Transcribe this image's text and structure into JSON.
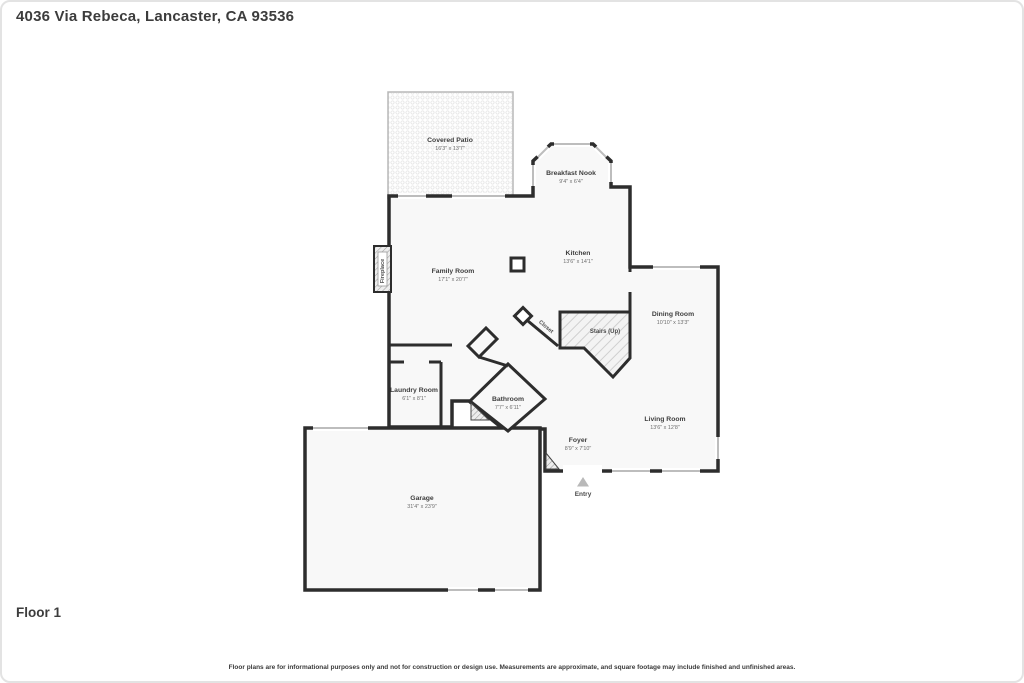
{
  "header": {
    "address": "4036 Via Rebeca, Lancaster, CA 93536"
  },
  "floor": {
    "label": "Floor 1"
  },
  "footer": {
    "disclaimer": "Floor plans are for informational purposes only and not for construction or design use. Measurements are approximate, and square footage may include finished and unfinished areas."
  },
  "floorplan": {
    "rooms": [
      {
        "id": "covered-patio",
        "name": "Covered Patio",
        "dims": "16'3\" x 13'7\""
      },
      {
        "id": "breakfast-nook",
        "name": "Breakfast Nook",
        "dims": "9'4\" x 6'4\""
      },
      {
        "id": "kitchen",
        "name": "Kitchen",
        "dims": "13'6\" x 14'1\""
      },
      {
        "id": "family-room",
        "name": "Family Room",
        "dims": "17'1\" x 20'7\""
      },
      {
        "id": "dining-room",
        "name": "Dining Room",
        "dims": "10'10\" x 13'3\""
      },
      {
        "id": "living-room",
        "name": "Living Room",
        "dims": "13'6\" x 12'8\""
      },
      {
        "id": "laundry-room",
        "name": "Laundry Room",
        "dims": "6'1\" x 8'1\""
      },
      {
        "id": "bathroom",
        "name": "Bathroom",
        "dims": "7'7\" x 6'11\""
      },
      {
        "id": "foyer",
        "name": "Foyer",
        "dims": "8'9\" x 7'10\""
      },
      {
        "id": "garage",
        "name": "Garage",
        "dims": "31'4\" x 23'9\""
      }
    ],
    "features": {
      "fireplace": "Fireplace",
      "closet": "Closet",
      "stairs": "Stairs (Up)",
      "entry": "Entry"
    },
    "colors": {
      "wall": "#2d2d2d",
      "floor": "#f8f8f8",
      "window": "#bdbdbd",
      "label": "#3e3e3e",
      "dims": "#6e6e6e"
    }
  }
}
